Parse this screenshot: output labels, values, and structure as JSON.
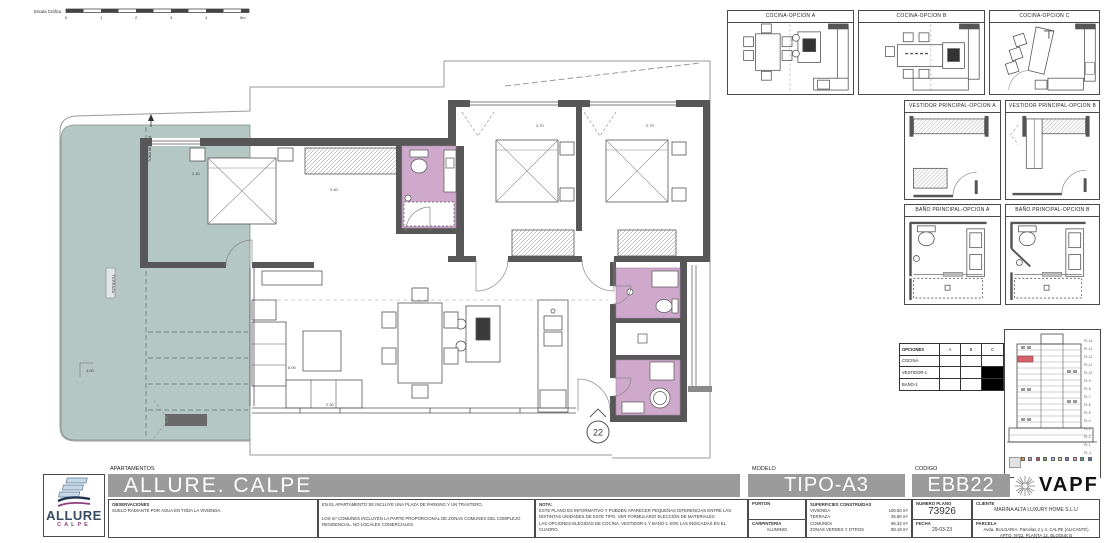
{
  "scale_bar": {
    "label": "Escala Gráfica",
    "ticks": [
      "0",
      "1",
      "2",
      "3",
      "4",
      "5m"
    ]
  },
  "plan": {
    "terrace_label": "TERRAZA",
    "water_label": "TOMA DE AGUA",
    "unit_marker": "22",
    "dims": {
      "dim_master": "2.40",
      "dim_hall": "2.40",
      "dim_bed2": "2.70",
      "dim_bed3": "2.70",
      "dim_living": "6.00",
      "dim_kitchen": "2.30",
      "dim_terrace": "4.50"
    }
  },
  "panels": {
    "cocina_a": "COCINA-OPCION A",
    "cocina_b": "COCINA-OPCION B",
    "cocina_c": "COCINA-OPCION C",
    "vestidor_a": "VESTIDOR PRINCIPAL-OPCION A",
    "vestidor_b": "VESTIDOR PRINCIPAL-OPCION B",
    "bano_a": "BAÑO PRINCIPAL-OPCION A",
    "bano_b": "BAÑO PRINCIPAL-OPCION B"
  },
  "options_table": {
    "header": [
      "OPCIONES",
      "A",
      "B",
      "C"
    ],
    "rows": [
      {
        "label": "COCINA",
        "a": "",
        "b": "",
        "c": ""
      },
      {
        "label": "VESTIDOR-1",
        "a": "",
        "b": "",
        "c": "filled"
      },
      {
        "label": "BAÑO-1",
        "a": "",
        "b": "",
        "c": "filled"
      }
    ]
  },
  "elevation": {
    "floors": [
      "PL.14",
      "PL.13",
      "PL.12",
      "PL.11",
      "PL.10",
      "PL.9",
      "PL.8",
      "PL.7",
      "PL.6",
      "PL.5",
      "PL.4",
      "PL.3",
      "PL.2",
      "PL.1",
      "PL.-1"
    ],
    "legend_colors": [
      "#e09a3e",
      "#c9a0c9",
      "#bf4f55",
      "#74ae57",
      "#9fc6e8",
      "#e3cf8e",
      "#9279bd",
      "#e0a9bc",
      "#3fa389",
      "#4c72b8"
    ]
  },
  "title_block": {
    "apartamentos_label": "APARTAMENTOS",
    "project_title": "ALLURE. CALPE",
    "modelo_label": "MODELO",
    "modelo": "TIPO-A3",
    "codigo_label": "CODIGO",
    "codigo": "EBB22",
    "brand": "VAPF",
    "logo_line1": "ALLURE",
    "logo_line2": "CALPE",
    "observaciones_label": "OBSERVACIONES",
    "observaciones": "SUELO RADIANTE POR AGUA EN TODA LA VIVIENDA.",
    "incluye1": "EN EL APARTAMENTO SE INCLUYE UNA PLAZA DE PARKING Y UN TRASTERO",
    "incluye2": "LOS m² COMUNES INCLUYEN LA PARTE PROPORCIONAL DE ZONAS COMUNES DEL COMPLEJO RESIDENCIAL. NO LOCALES COMERCIALES.",
    "nota_label": "NOTA:",
    "nota1": "ESTE PLANO ES INFORMATIVO Y PUEDEN APARECER PEQUEÑAS DIFERENCIAS ENTRE LAS DISTINTAS UNIDADES DE ESTE TIPO. VER FORMULARIO ELECCIÓN DE MATERIALES",
    "nota2": "LAS OPCIONES ELEGIDAS DE COCINA, VESTIDOR-1 Y BAÑO-1 SON LAS INDICADAS EN EL CUADRO.",
    "porton_label": "PORTON",
    "carpinteria_label": "CARPINTERIA",
    "carpinteria_value": "ALUMINIO",
    "superficies_label": "SUPERFICIES CONSTRUIDAS",
    "superficies": [
      {
        "name": "VIVIENDA",
        "value": "106.50 m²"
      },
      {
        "name": "TERRAZA",
        "value": "35.80 m²"
      },
      {
        "name": "COMUNES",
        "value": "96.32 m²"
      },
      {
        "name": "ZONAS VERDES Y OTROS",
        "value": "88.18 m²"
      }
    ],
    "numero_plano_label": "NUMERO PLANO",
    "numero_plano": "73926",
    "fecha_label": "FECHA",
    "fecha": "29-03-23",
    "cliente_label": "CLIENTE",
    "cliente": "MARINA ALTA LUXURY HOME S.L.U",
    "parcela_label": "PARCELA",
    "parcela1": "Avda. BULGARIA, Parcelas 2 y 4. CALPE (ALICANTE)",
    "parcela2": "APTO. Nº22, PLANTA 12, BLOQUE B"
  },
  "colors": {
    "wall": "#575757",
    "terrace": "#b5c7c3",
    "bath": "#cfa9cb",
    "bar": "#9b9b9b",
    "highlight": "#d4626a"
  }
}
